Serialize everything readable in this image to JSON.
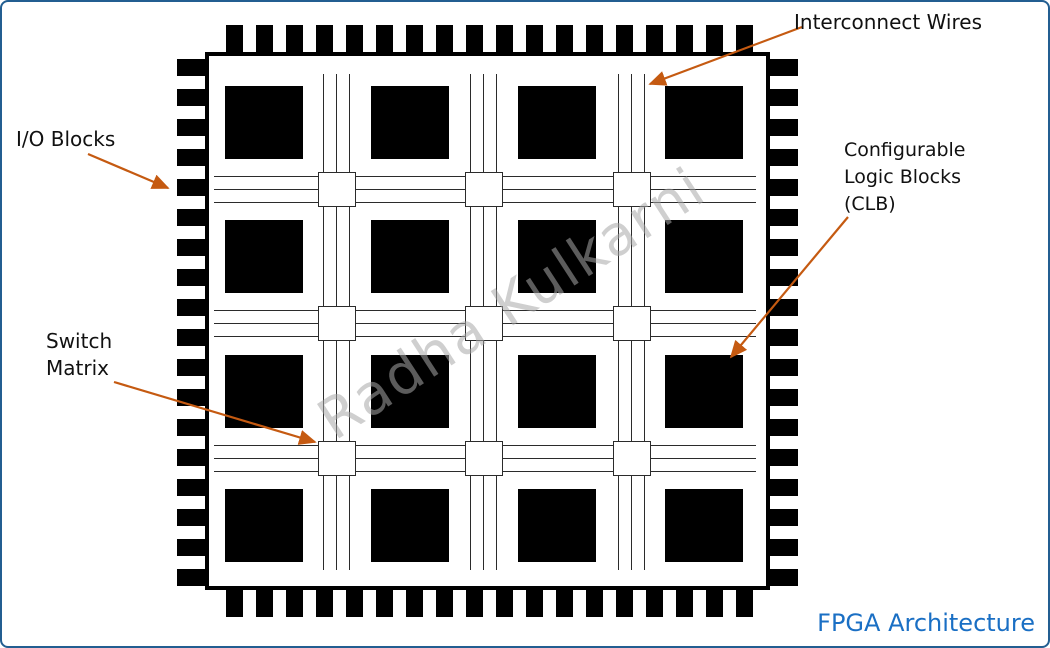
{
  "title": "FPGA Architecture",
  "watermark": "Radha Kulkarni",
  "labels": {
    "interconnect_wires": "Interconnect Wires",
    "io_blocks": "I/O Blocks",
    "switch_matrix": "Switch Matrix",
    "clb": "Configurable Logic Blocks (CLB)"
  },
  "colors": {
    "arrow_orange": "#C55A11",
    "title_blue": "#1A6FC4",
    "frame_blue": "#235E91",
    "block_black": "#000000",
    "wire_gray": "#2B2B2B",
    "watermark_gray": "#A8A8A8"
  },
  "diagram": {
    "type": "fpga-architecture",
    "clb_rows": 4,
    "clb_cols": 4,
    "switch_matrix_rows": 3,
    "switch_matrix_cols": 3,
    "wires_per_channel": 3,
    "io_pins_per_side": 18
  }
}
